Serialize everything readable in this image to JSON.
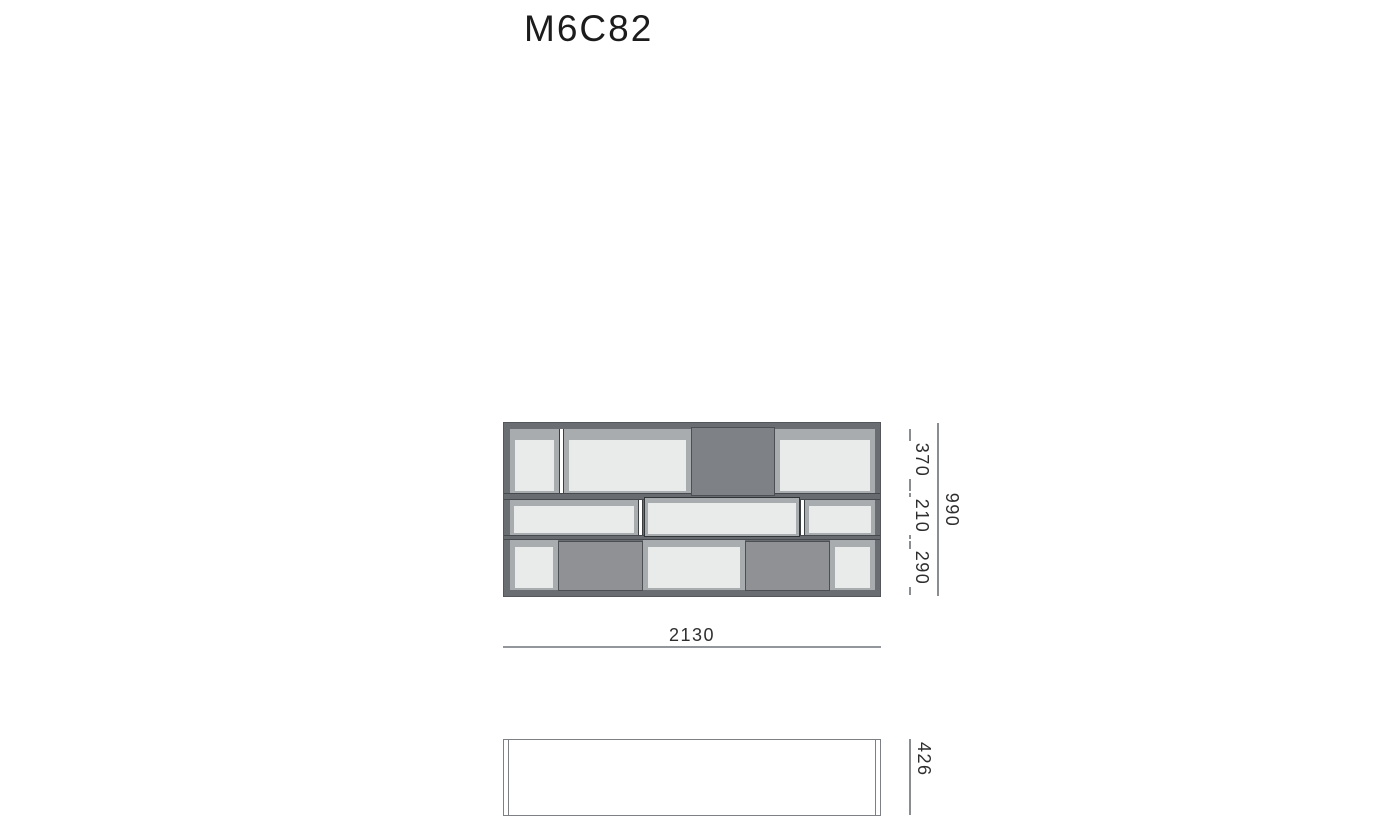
{
  "title": "M6C82",
  "dimensions": {
    "front_width": {
      "label": "2130"
    },
    "front_height_total": {
      "label": "990"
    },
    "front_height_segments": [
      {
        "label": "370"
      },
      {
        "label": "210"
      },
      {
        "label": "290"
      }
    ],
    "top_view_depth": {
      "label": "426"
    }
  },
  "front_view": {
    "width_mm": 2130,
    "height_mm": 990,
    "rows": [
      {
        "height_mm": 370,
        "cells": [
          "open-compartment",
          "open-compartment",
          "closed-door",
          "open-compartment"
        ]
      },
      {
        "height_mm": 210,
        "cells": [
          "open-compartment",
          "drawer",
          "open-compartment"
        ]
      },
      {
        "height_mm": 290,
        "cells": [
          "open-compartment",
          "closed-door",
          "open-compartment",
          "closed-door",
          "open-compartment"
        ]
      }
    ]
  },
  "top_view": {
    "depth_mm": 426
  },
  "colors": {
    "frame": "#6a6d71",
    "compartment_shading": "#a9acaf",
    "compartment_interior": "#e9eaea",
    "door_top_row": "#7e8185",
    "door_bottom_row": "#8f9194",
    "dimension_line": "#8b8e91",
    "text": "#1c1c1c",
    "background": "#ffffff"
  }
}
